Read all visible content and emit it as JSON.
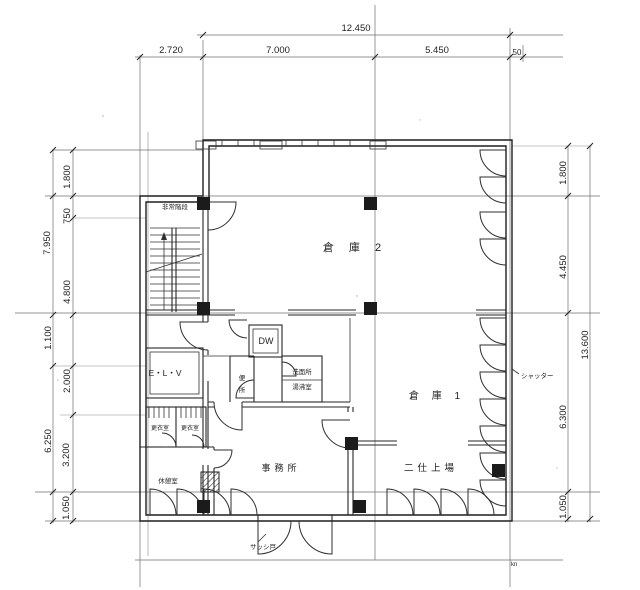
{
  "colors": {
    "paper": "#ffffff",
    "ink": "#1f1f1f",
    "construction_line": "#6f6f6f"
  },
  "dimensions": {
    "top": {
      "total": "12.450",
      "seg1": "2.720",
      "seg2": "7.000",
      "seg3": "5.450",
      "seg4": "50"
    },
    "left": {
      "outer1": "7.950",
      "outer2": "1.100",
      "outer3": "6.250",
      "inner1": "1.800",
      "inner2": "750",
      "inner3": "4.800",
      "inner4": "2.000",
      "inner5": "3.200",
      "inner6": "1.050"
    },
    "right": {
      "outer1": "13.600",
      "inner1": "1.800",
      "inner2": "4.450",
      "inner3": "6.300",
      "inner4": "1.050"
    }
  },
  "rooms": {
    "warehouse2": "倉 庫 2",
    "warehouse1": "倉 庫 1",
    "dumbwaiter": "DW",
    "washroom_line1": "洗面所",
    "washroom_line2": "湯沸室",
    "toilet_chars": [
      "便",
      "所"
    ],
    "elevator": "E・L・V",
    "emergency_stairs": "非常階段",
    "locker_room_left": "更衣室",
    "locker_room_right": "更衣室",
    "rest_room": "休憩室",
    "office": "事務所",
    "finishing_area": "二仕上場"
  },
  "annotations": {
    "right_wall_note": "シャッター",
    "entrance_note": "サッシ戸",
    "corner_mark": "kn"
  }
}
